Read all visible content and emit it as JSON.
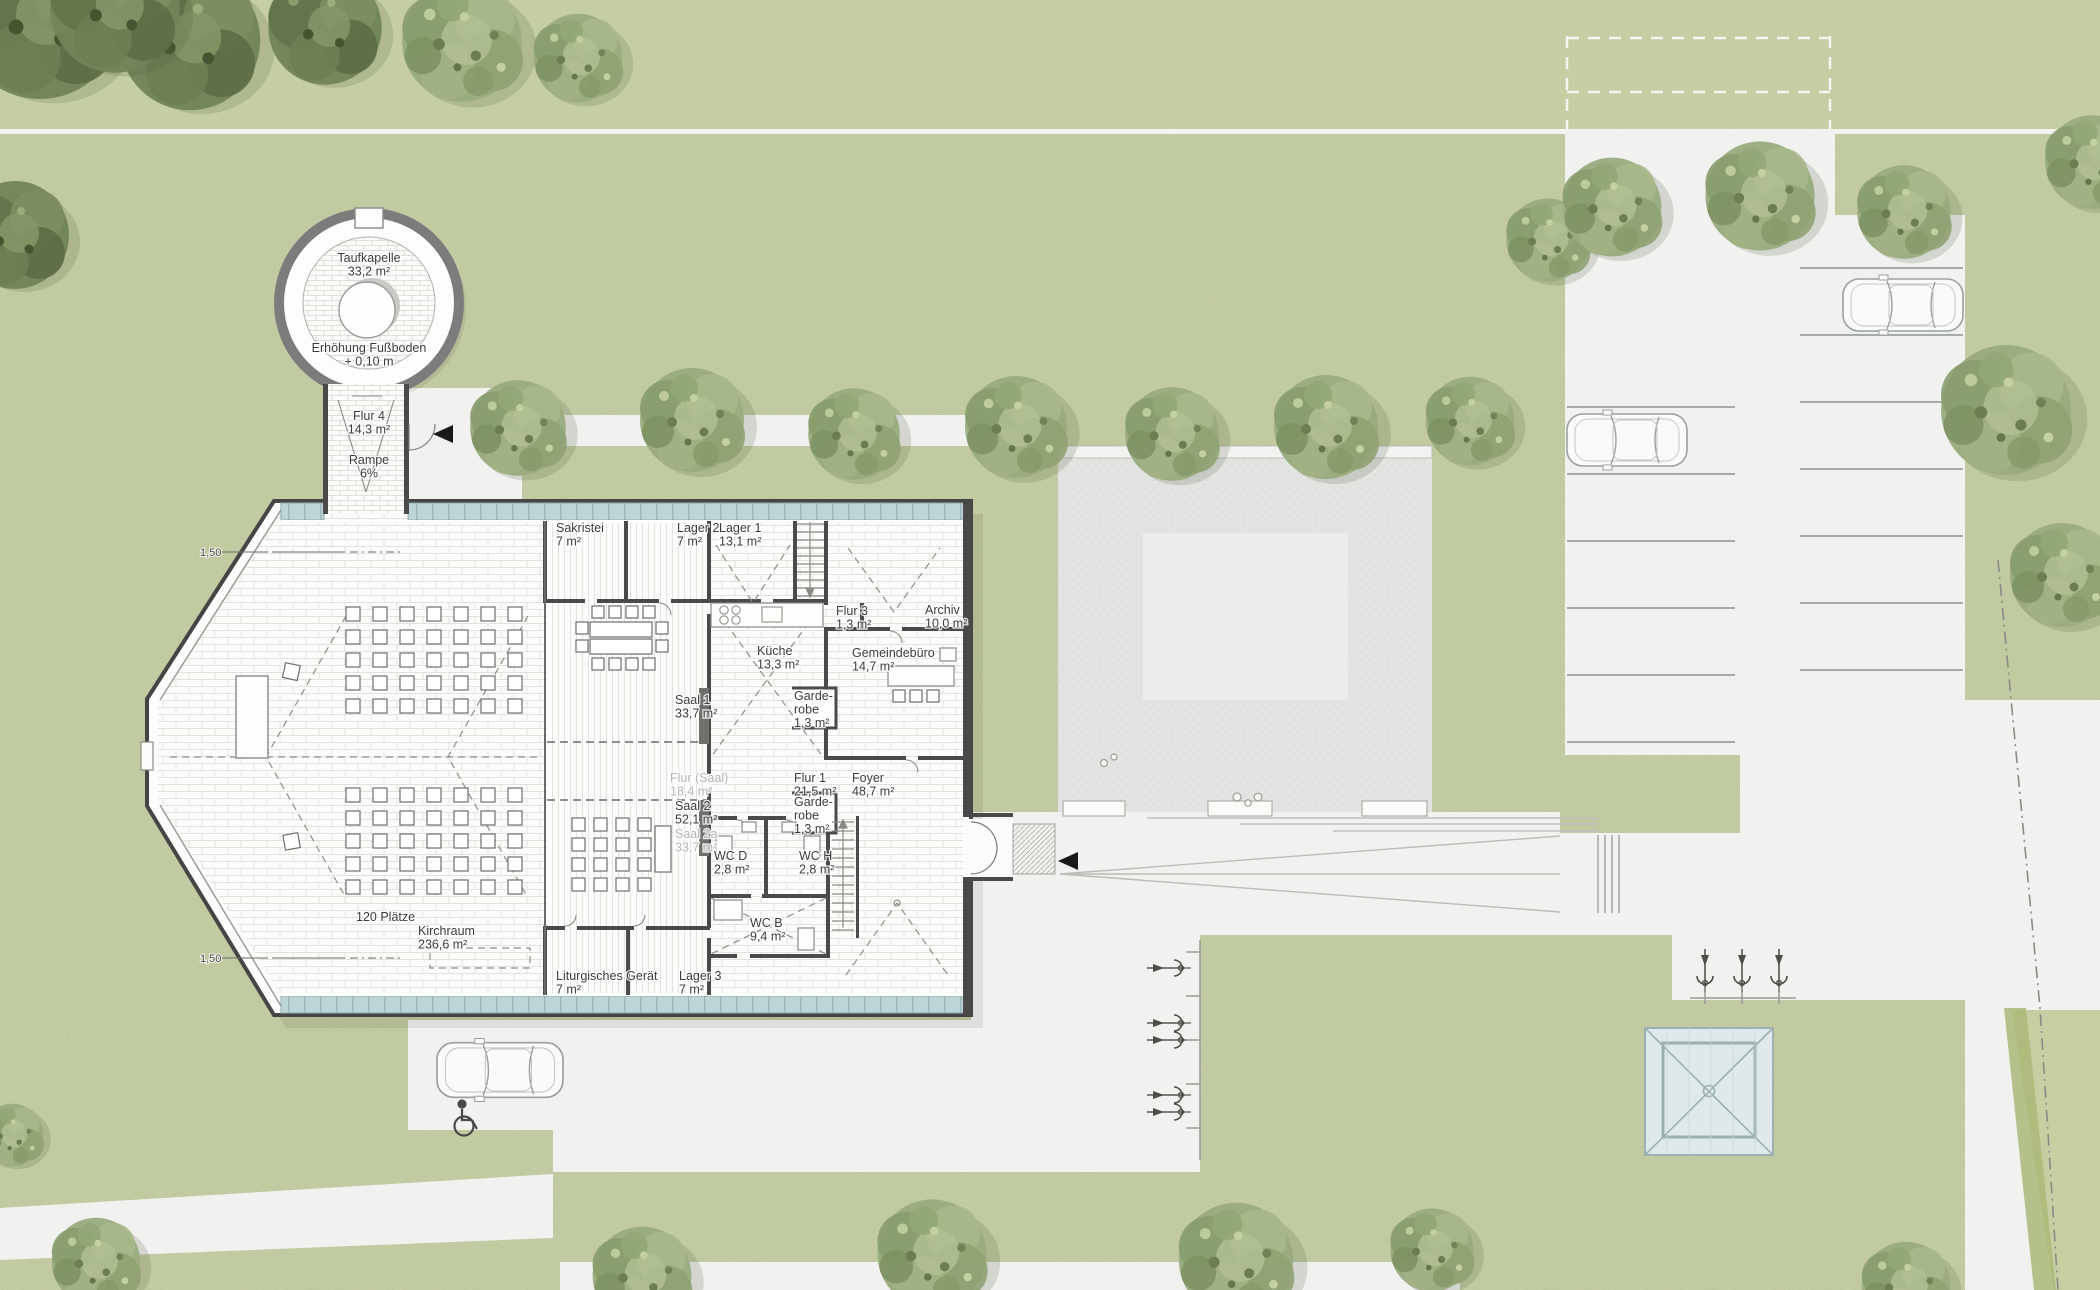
{
  "title": "Lageplan Erdgeschoss – Kirche mit Gemeindezentrum",
  "colors": {
    "grass": "#ccd5ab",
    "grass_band": "#c7d0a4",
    "path_white": "#f1f1ef",
    "plaza": "#e3e3e1",
    "plaza_inner": "#ecedeb",
    "wall": "#4a4a4a",
    "glazing": "#bdd5d7",
    "pavilion_glass": "#dfe9e9",
    "tree_green": "#8a9c6e",
    "label_ink": "#3c3c3c",
    "label_muted": "#b4b4b1"
  },
  "symbols": {
    "icons": [
      "tree-icon",
      "car-icon",
      "bike-icon",
      "bench-icon",
      "wheelchair-icon",
      "entrance-arrow-icon",
      "stair-icon",
      "door-swing-icon",
      "glass-pavilion-icon"
    ]
  },
  "rooms": [
    {
      "lines": [
        "Taufkapelle",
        "33,2 m²"
      ],
      "x": 369,
      "y": 262,
      "anchor": "middle",
      "muted": false
    },
    {
      "lines": [
        "Erhöhung Fußboden",
        "+ 0,10 m"
      ],
      "x": 369,
      "y": 352,
      "anchor": "middle",
      "muted": false
    },
    {
      "lines": [
        "Flur 4",
        "14,3 m²"
      ],
      "x": 369,
      "y": 420,
      "anchor": "middle",
      "muted": false
    },
    {
      "lines": [
        "Rampe",
        "6%"
      ],
      "x": 369,
      "y": 464,
      "anchor": "middle",
      "muted": false
    },
    {
      "lines": [
        "Sakristei",
        "7 m²"
      ],
      "x": 556,
      "y": 532,
      "anchor": "start",
      "muted": false
    },
    {
      "lines": [
        "Lager 2",
        "7 m²"
      ],
      "x": 677,
      "y": 532,
      "anchor": "start",
      "muted": false
    },
    {
      "lines": [
        "Lager 1",
        "13,1 m²"
      ],
      "x": 719,
      "y": 532,
      "anchor": "start",
      "muted": false
    },
    {
      "lines": [
        "Flur 3",
        "1,3 m²"
      ],
      "x": 836,
      "y": 615,
      "anchor": "start",
      "muted": false
    },
    {
      "lines": [
        "Archiv",
        "10,0 m²"
      ],
      "x": 925,
      "y": 614,
      "anchor": "start",
      "muted": false
    },
    {
      "lines": [
        "Küche",
        "13,3 m²"
      ],
      "x": 757,
      "y": 655,
      "anchor": "start",
      "muted": false
    },
    {
      "lines": [
        "Gemeindebüro",
        "14,7 m²"
      ],
      "x": 852,
      "y": 657,
      "anchor": "start",
      "muted": false
    },
    {
      "lines": [
        "Saal 1",
        "33,7 m²"
      ],
      "x": 675,
      "y": 704,
      "anchor": "start",
      "muted": false
    },
    {
      "lines": [
        "Garde-",
        "robe",
        "1,3 m²"
      ],
      "x": 794,
      "y": 700,
      "anchor": "start",
      "muted": false
    },
    {
      "lines": [
        "Flur (Saal)",
        "18,4 m²"
      ],
      "x": 670,
      "y": 782,
      "anchor": "start",
      "muted": true
    },
    {
      "lines": [
        "Flur 1",
        "21,5 m²"
      ],
      "x": 794,
      "y": 782,
      "anchor": "start",
      "muted": false
    },
    {
      "lines": [
        "Foyer",
        "48,7 m²"
      ],
      "x": 852,
      "y": 782,
      "anchor": "start",
      "muted": false
    },
    {
      "lines": [
        "Saal 2",
        "52,1 m²"
      ],
      "x": 675,
      "y": 810,
      "anchor": "start",
      "muted": false
    },
    {
      "lines": [
        "Saal 2a",
        "33,7 m²"
      ],
      "x": 675,
      "y": 838,
      "anchor": "start",
      "muted": true
    },
    {
      "lines": [
        "Garde-",
        "robe",
        "1,3 m²"
      ],
      "x": 794,
      "y": 806,
      "anchor": "start",
      "muted": false
    },
    {
      "lines": [
        "WC D",
        "2,8 m²"
      ],
      "x": 714,
      "y": 860,
      "anchor": "start",
      "muted": false
    },
    {
      "lines": [
        "WC H",
        "2,8 m²"
      ],
      "x": 799,
      "y": 860,
      "anchor": "start",
      "muted": false
    },
    {
      "lines": [
        "WC B",
        "9,4 m²"
      ],
      "x": 750,
      "y": 927,
      "anchor": "start",
      "muted": false
    },
    {
      "lines": [
        "120 Plätze"
      ],
      "x": 356,
      "y": 921,
      "anchor": "start",
      "muted": false
    },
    {
      "lines": [
        "Kirchraum",
        "236,6 m²"
      ],
      "x": 418,
      "y": 935,
      "anchor": "start",
      "muted": false
    },
    {
      "lines": [
        "Liturgisches Gerät",
        "7 m²"
      ],
      "x": 556,
      "y": 980,
      "anchor": "start",
      "muted": false
    },
    {
      "lines": [
        "Lager 3",
        "7 m²"
      ],
      "x": 679,
      "y": 980,
      "anchor": "start",
      "muted": false
    }
  ],
  "annotations": [
    {
      "text": "1,50",
      "x": 200,
      "y": 556
    },
    {
      "text": "1,50",
      "x": 200,
      "y": 962
    }
  ]
}
